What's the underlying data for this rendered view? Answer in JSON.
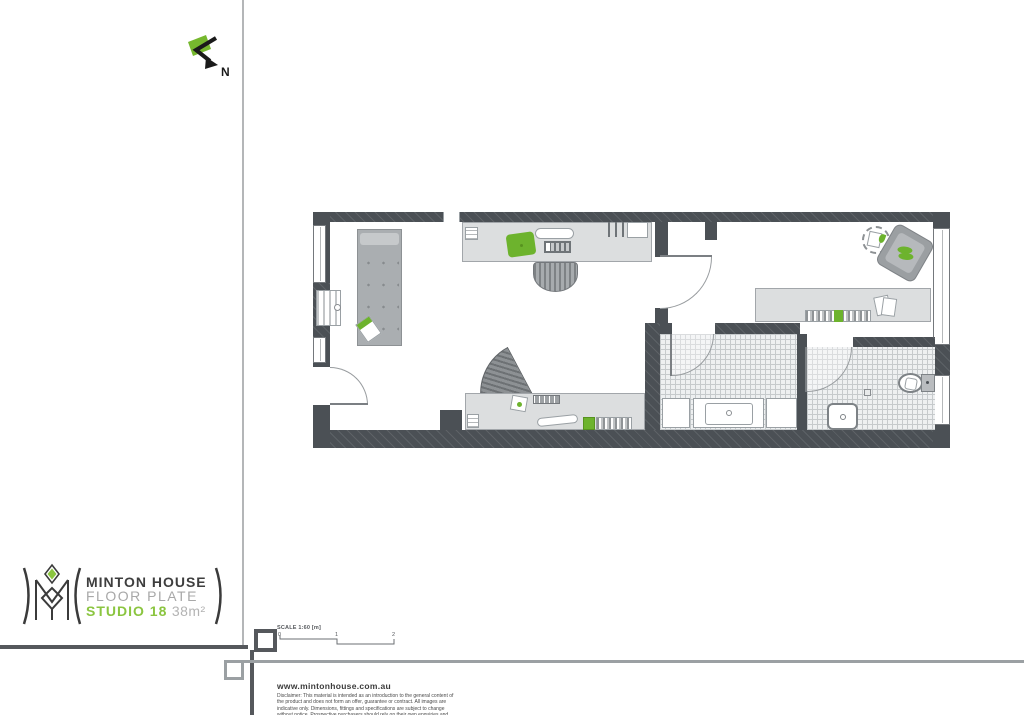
{
  "north": {
    "label": "N"
  },
  "scale_bar": {
    "label": "SCALE 1:60 [m]",
    "ticks": [
      "0",
      "1",
      "2"
    ]
  },
  "logo": {
    "title": "MINTON HOUSE",
    "subtitle": "FLOOR PLATE",
    "unit": "STUDIO 18",
    "area": "38m²"
  },
  "footer": {
    "website": "www.mintonhouse.com.au",
    "disclaimer": "Disclaimer: This material is intended as an introduction to the general content of the product and does not form an offer, guarantee or contract. All images are indicative only. Dimensions, fittings and specifications are subject to change without notice. Prospective purchasers should rely on their own enquiries and contract for sale."
  },
  "colors": {
    "wall": "#4b5055",
    "furniture_light": "#dcdedf",
    "furniture_mid": "#a9adb0",
    "accent_green": "#6db32d",
    "logo_green": "#8bc540",
    "line_gray": "#9ba0a3"
  },
  "plan": {
    "furniture": [
      "bed",
      "kitchen-counter",
      "sink",
      "cooktop",
      "cutting-board",
      "stool",
      "desk",
      "office-chair",
      "books",
      "armchair",
      "plant-side-table",
      "console-desk",
      "washer",
      "laundry-tub",
      "toilet",
      "wash-basin",
      "entry-door",
      "internal-door",
      "laundry-door",
      "bathroom-door",
      "windows",
      "tiled-bathroom-floor",
      "radiator"
    ]
  }
}
